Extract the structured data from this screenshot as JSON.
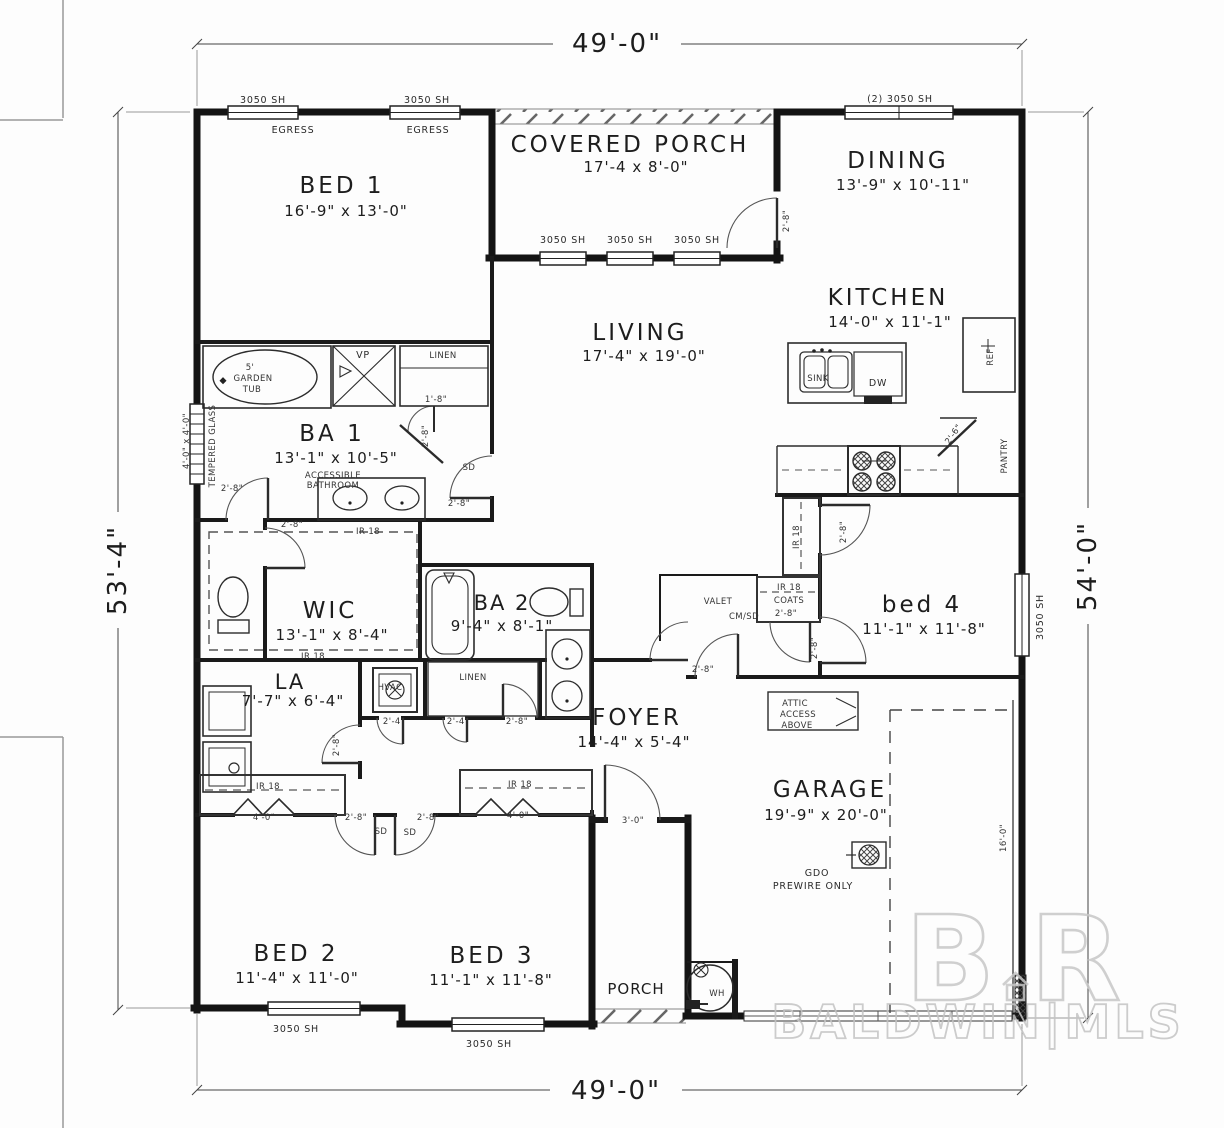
{
  "dimensions": {
    "top": "49'-0\"",
    "bottom": "49'-0\"",
    "left": "53'-4\"",
    "right": "54'-0\""
  },
  "rooms": {
    "bed1": {
      "name": "BED 1",
      "dims": "16'-9\" x 13'-0\""
    },
    "covered_porch": {
      "name": "COVERED PORCH",
      "dims": "17'-4 x 8'-0\""
    },
    "dining": {
      "name": "DINING",
      "dims": "13'-9\" x 10'-11\""
    },
    "kitchen": {
      "name": "KITCHEN",
      "dims": "14'-0\" x 11'-1\""
    },
    "living": {
      "name": "LIVING",
      "dims": "17'-4\" x 19'-0\""
    },
    "ba1": {
      "name": "BA 1",
      "dims": "13'-1\" x 10'-5\"",
      "note1": "ACCESSIBLE",
      "note2": "BATHROOM"
    },
    "wic": {
      "name": "WIC",
      "dims": "13'-1\" x 8'-4\""
    },
    "ba2": {
      "name": "BA 2",
      "dims": "9'-4\" x 8'-1\""
    },
    "la": {
      "name": "LA",
      "dims": "7'-7\" x 6'-4\""
    },
    "foyer": {
      "name": "FOYER",
      "dims": "14'-4\" x 5'-4\""
    },
    "bed4": {
      "name": "bed 4",
      "dims": "11'-1\" x 11'-8\""
    },
    "garage": {
      "name": "GARAGE",
      "dims": "19'-9\" x 20'-0\""
    },
    "bed2": {
      "name": "BED 2",
      "dims": "11'-4\" x 11'-0\""
    },
    "bed3": {
      "name": "BED 3",
      "dims": "11'-1\" x 11'-8\""
    },
    "porch": {
      "name": "PORCH"
    }
  },
  "windows": {
    "sh": "3050 SH",
    "sh2": "(2) 3050 SH",
    "egress": "EGRESS",
    "tempered": "TEMPERED GLASS",
    "tempered_size": "4'-0\" x 4'-0\""
  },
  "doors": {
    "d18": "1'-8\"",
    "d24": "2'-4\"",
    "d26": "2'-6\"",
    "d28": "2'-8\"",
    "d30": "3'-0\"",
    "d40": "4'-0\"",
    "sd": "SD"
  },
  "closets": {
    "ir18": "IR 18",
    "linen": "LINEN",
    "coats": "COATS",
    "valet": "VALET",
    "cmsd": "CM/SD",
    "pantry": "PANTRY"
  },
  "fixtures": {
    "tub_size": "5'",
    "tub_l1": "GARDEN",
    "tub_l2": "TUB",
    "vp": "VP",
    "sink": "SINK",
    "dw": "DW",
    "ref": "REF",
    "hvac": "HVAC",
    "wh": "WH",
    "gdo": "GDO",
    "prewire": "PREWIRE ONLY",
    "attic_l1": "ATTIC",
    "attic_l2": "ACCESS",
    "attic_l3": "ABOVE",
    "garage_door_dim": "16'-0\""
  },
  "watermark": {
    "b": "B",
    "r": "R",
    "mls": "BALDWIN|MLS"
  }
}
